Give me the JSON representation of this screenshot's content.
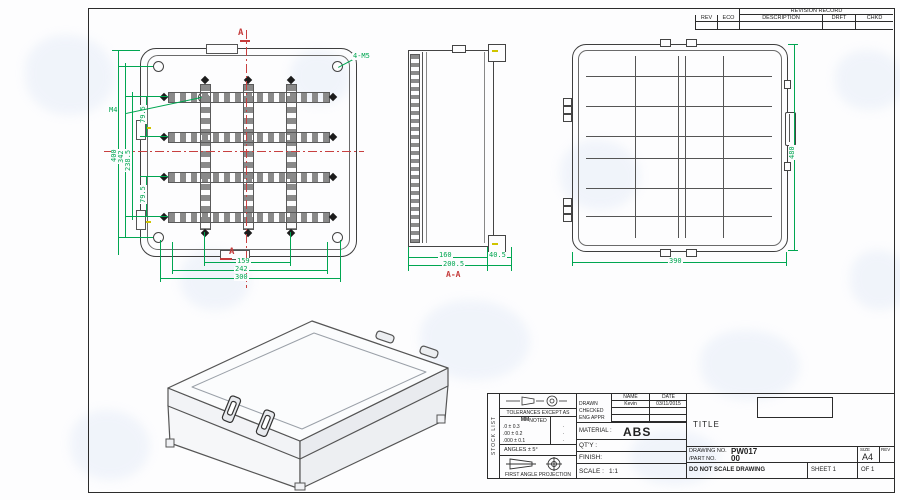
{
  "colors": {
    "dim_green": "#00a651",
    "section_red": "#c53b3b",
    "line_dark": "#3c3c3c",
    "accent_yellow": "#cfc400",
    "watermark_blue": "#b9cdec"
  },
  "revision_table": {
    "title": "REVISION RECORD",
    "columns": [
      "REV",
      "ECO",
      "DESCRIPTION",
      "DRFT",
      "CHKD"
    ]
  },
  "front_view": {
    "section_letter_top": "A",
    "section_letter_bottom": "A",
    "callout_corner_holes": "4-M5",
    "callout_boss": "M4",
    "bottom_dims": [
      "159",
      "242",
      "300"
    ],
    "left_dims": [
      "400",
      "342",
      "238.5"
    ],
    "spacing_dims": [
      "79.5",
      "79.5"
    ]
  },
  "side_view": {
    "section_label": "A-A",
    "bottom_dims": [
      "160",
      "40.5",
      "200.5"
    ]
  },
  "back_view": {
    "width_dim": "390",
    "height_dim": "480"
  },
  "title_block": {
    "side_strip": "STOCK LIST",
    "tolerances_heading": "TOLERANCES EXCEPT AS NOTED",
    "unit_header": "MM",
    "tolerance_rows": [
      ".0 ± 0.3",
      ".00 ± 0.2",
      ".000 ± 0.1"
    ],
    "tolerance_marks": [
      "·",
      "·",
      "·"
    ],
    "angles": "ANGLES ± 5°",
    "projection": "FIRST ANGLE PROJECTION",
    "name_header": "NAME",
    "date_header": "DATE",
    "approval_rows": [
      {
        "role": "DRAWN",
        "name": "Kevin",
        "date": "03/11/2015"
      },
      {
        "role": "CHECKED",
        "name": "",
        "date": ""
      },
      {
        "role": "ENG APPR",
        "name": "",
        "date": ""
      }
    ],
    "material_label": "MATERIAL :",
    "material_value": "ABS",
    "qty_label": "QT'Y :",
    "finish_label": "FINISH:",
    "scale_label": "SCALE :",
    "scale_value": "1:1",
    "title_label": "TITLE",
    "drawing_no_label": "DRAWING NO.",
    "drawing_no": "PW017",
    "part_no_label": "/PART NO.",
    "part_no": "00",
    "size_label": "SIZE",
    "size_value": "A4",
    "rev_label": "REV",
    "do_not_scale": "DO NOT SCALE DRAWING",
    "sheet_label": "SHEET 1",
    "of_label": "OF 1"
  }
}
